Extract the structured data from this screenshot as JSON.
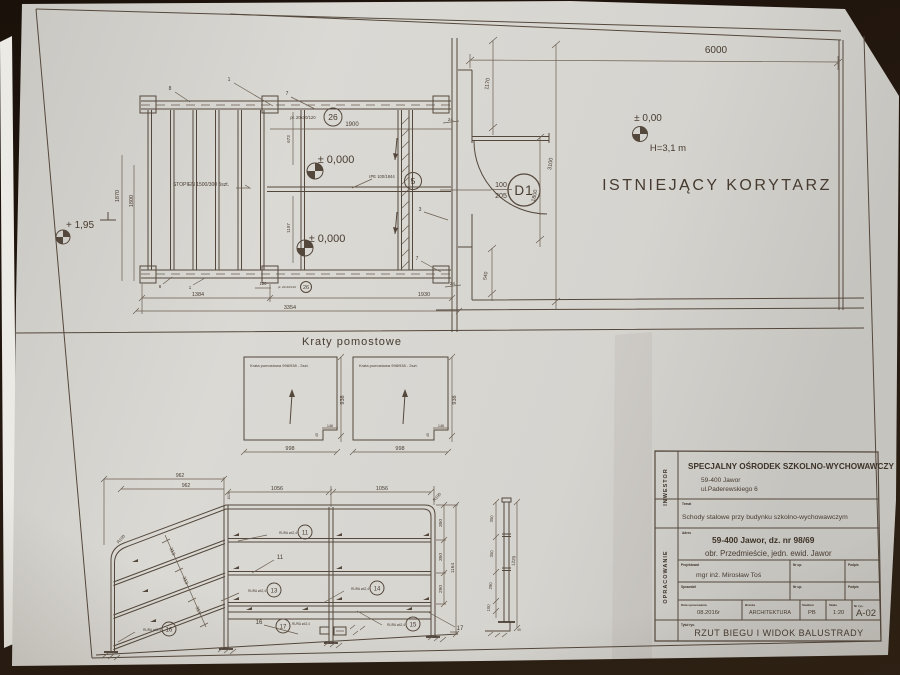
{
  "photo": {
    "background": "#1d140c",
    "paper": "#d7d5d0",
    "ink": "#51463c"
  },
  "sheet": {
    "corridor": {
      "dim_6000": "6000",
      "dim_1170": "1170",
      "dim_3100": "3100",
      "dim_1800": "1800",
      "dim_540": "540",
      "dim_24_top": "24.",
      "dim_24_bottom": "24.",
      "door_tag": "D1",
      "door_width": "100",
      "door_height": "205",
      "level": "± 0,00",
      "height_note": "H=3,1 m",
      "room_label": "ISTNIEJĄCY KORYTARZ"
    },
    "stairs": {
      "level_plus": "+ 1,95",
      "level_zero_a": "± 0,000",
      "level_zero_b": "± 0,000",
      "tread_note": "STOPIEŃ 1500/300  5szt.",
      "plate_note": "pł. 20x10/120",
      "plate_item": "26",
      "plate_note_small": "pł. 20x10/120",
      "plate_item_small": "26",
      "beam_note": "IPE 100/1844",
      "beam_item": "5",
      "dim_1870": "1870",
      "dim_1800": "1800",
      "dim_673": "673",
      "dim_1197": "1197",
      "dim_1900": "1900",
      "dim_1384": "1384",
      "dim_1930": "1930",
      "dim_3354": "3354",
      "dim_120": "120",
      "ref_8a": "8",
      "ref_1a": "1",
      "ref_7a": "7",
      "ref_7b": "7",
      "ref_3": "3",
      "ref_8b": "8",
      "ref_1b": "1"
    },
    "gratings": {
      "title": "Kraty pomostowe",
      "panel_label": "Krata pomostowa 998/938 - 2szt.",
      "dim_998": "998",
      "dim_938": "938",
      "dim_146": "146",
      "dim_45": "45"
    },
    "balustrade": {
      "dim_962_outer": "962",
      "dim_962_inner": "962",
      "dim_1056_left": "1056",
      "dim_1056_right": "1056",
      "dim_1028": "1028",
      "r100": "R100",
      "dim_313": "313",
      "dim_350": "350",
      "dim_290": "290",
      "dim_1164": "1164",
      "item_11": "11",
      "item_13": "13",
      "item_14": "14",
      "item_15": "15",
      "item_16": "16",
      "item_17": "17",
      "ref_11": "11",
      "ref_16": "16",
      "ref_17": "17",
      "tube_label": "RURA ø42,4"
    },
    "post": {
      "dim_350": "350",
      "dim_290": "290",
      "dim_100": "100",
      "dim_1220": "1220",
      "dim_45": "45"
    },
    "titleblock": {
      "investor_label": "INWESTOR",
      "opracowanie_label": "OPRACOWANIE",
      "investor": "SPECJALNY OŚRODEK SZKOLNO-WYCHOWAWCZY",
      "investor_addr1": "59-400 Jawor",
      "investor_addr2": "ul.Paderewskiego 6",
      "temat_label": "Temat",
      "temat": "Schody stalowe przy budynku szkolno-wychowawczym",
      "adres_label": "Adres",
      "adres1": "59-400 Jawor, dz. nr 98/69",
      "adres2": "obr. Przedmieście, jedn. ewid. Jawor",
      "projektowal_label": "Projektował",
      "projektowal": "mgr inż. Mirosław Toś",
      "sprawdzil_label": "Sprawdził",
      "nr_up_label": "Nr up.",
      "podpis_label": "Podpis",
      "data_label": "Data opracowania",
      "data": "08.2016r",
      "branza_label": "Branża",
      "branza": "ARCHITEKTURA",
      "stadium_label": "Stadium",
      "stadium": "PB",
      "skala_label": "Skala",
      "skala": "1:20",
      "nr_rys_label": "Nr rys.",
      "nr_rys": "A-02",
      "tytul_label": "Tytuł rys.",
      "tytul": "RZUT BIEGU I WIDOK BALUSTRADY"
    }
  }
}
